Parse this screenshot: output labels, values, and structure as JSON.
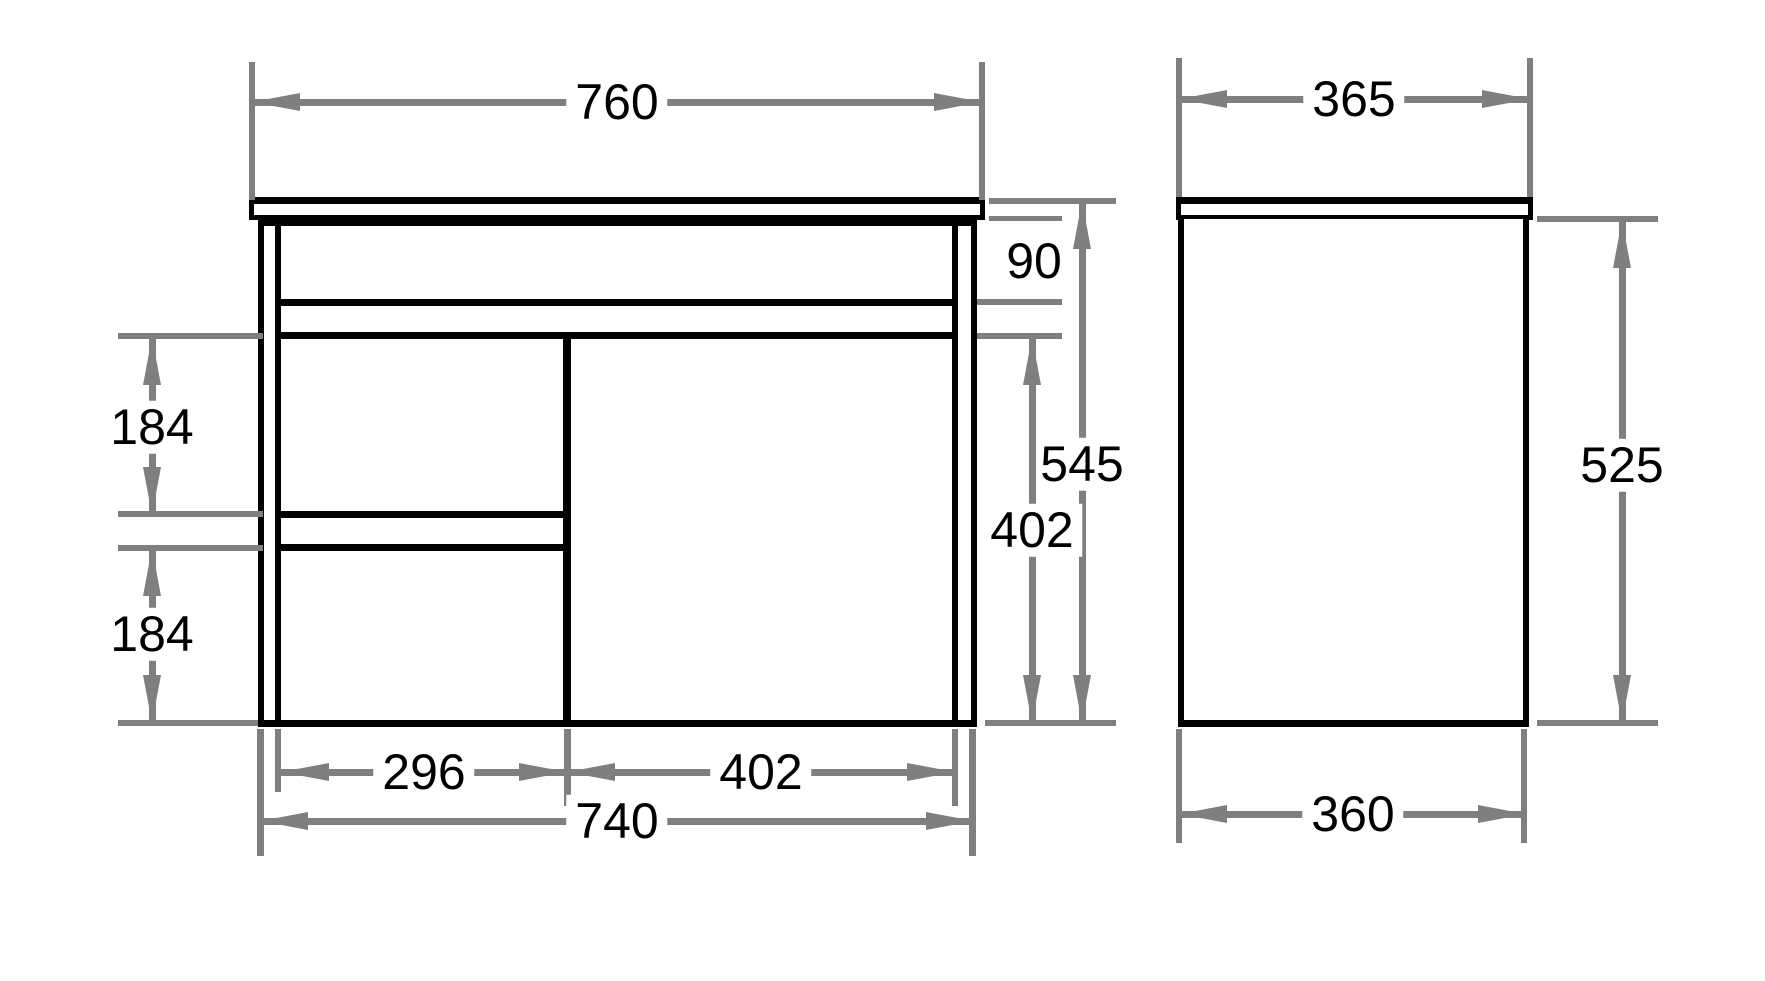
{
  "colors": {
    "outline": "#000000",
    "dimension": "#7f7f7f",
    "background": "#ffffff"
  },
  "views": {
    "front": {
      "dimensions": {
        "top_width": "760",
        "apron_height": "90",
        "carcass_height": "545",
        "door_height": "402",
        "upper_drawer_height": "184",
        "lower_drawer_height": "184",
        "drawer_bank_width": "296",
        "door_width": "402",
        "cabinet_width": "740"
      }
    },
    "side": {
      "dimensions": {
        "top_depth": "365",
        "body_height": "525",
        "bottom_depth": "360"
      }
    }
  }
}
